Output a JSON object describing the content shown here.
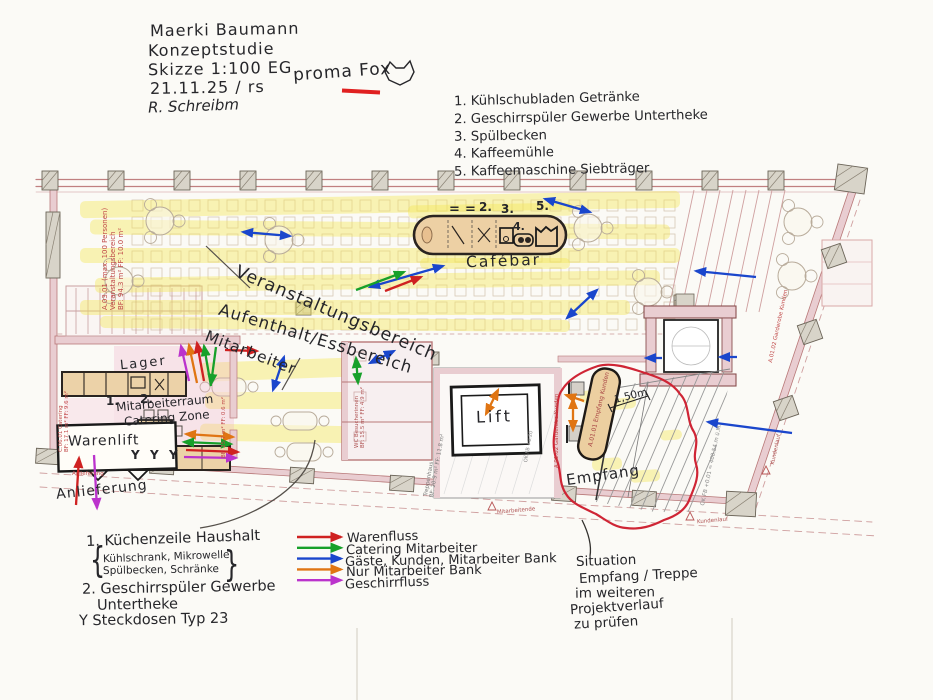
{
  "colors": {
    "ink": "#26262a",
    "red": "#cf2121",
    "green": "#17a02a",
    "blue": "#1a46cc",
    "orange": "#e07513",
    "magenta": "#bb33cc",
    "highlight": "#f2e756",
    "plan_red": "#c04848",
    "plan_pink": "#c98f96"
  },
  "header": {
    "line1": "Maerki Baumann",
    "line2": "Konzeptstudie",
    "line3": "Skizze 1:100 EG",
    "line4": "21.11.25 / rs",
    "line5": "R. Schreibm",
    "stamp": "proma Fox"
  },
  "equipment": {
    "items": [
      "1. Kühlschubladen Getränke",
      "2. Geschirrspüler Gewerbe Untertheke",
      "3. Spülbecken",
      "4. Kaffeemühle",
      "5. Kaffeemaschine Siebträger"
    ]
  },
  "legend": {
    "items": [
      {
        "label": "Warenfluss",
        "color": "#cf2121"
      },
      {
        "label": "Catering Mitarbeiter",
        "color": "#17a02a"
      },
      {
        "label": "Gäste, Kunden, Mitarbeiter Bank",
        "color": "#1a46cc"
      },
      {
        "label": "Nur Mitarbeiter Bank",
        "color": "#e07513"
      },
      {
        "label": "Geschirrfluss",
        "color": "#bb33cc"
      }
    ]
  },
  "notes_left": {
    "item1": "1. Küchenzeile Haushalt",
    "item1_sub1": "Kühlschrank, Mikrowelle,",
    "item1_sub2": "Spülbecken, Schränke",
    "brace_open": "{",
    "brace_close": "}",
    "item2": "2. Geschirrspüler Gewerbe",
    "item2b": "Untertheke",
    "item3": "Y Steckdosen Typ 23"
  },
  "notes_right": {
    "line1": "Situation",
    "line2": "Empfang / Treppe",
    "line3": "im weiteren",
    "line4": "Projektverlauf",
    "line5": "zu prüfen"
  },
  "labels": {
    "event": "Veranstaltungsbereich",
    "lounge": "Aufenthalt/Essbereich",
    "staff": "Mitarbeiter",
    "cafebar": "Cafébar",
    "lager": "Lager",
    "staffroom": "Mitarbeiterraum",
    "staffroom2": "Catering Zone",
    "warenlift": "Warenlift",
    "anlieferung": "Anlieferung",
    "lift": "Lift",
    "empfang": "Empfang",
    "dim": "1,50m"
  },
  "markers": {
    "counter1": "1.",
    "counter2": "2.",
    "bar_eq1": "=",
    "bar_eq2": "=",
    "bar2": "2.",
    "bar3": "3.",
    "bar4": "4.",
    "bar5": "5.",
    "socket1": "Y",
    "socket2": "Y",
    "socket3": "Y"
  },
  "printed": {
    "event1": "A.03.01 (max. 100 Personen)",
    "event2": "Veranstaltungsbereich",
    "event3": "BF: 94.3 m²  FF: 10.0 m²",
    "catering1": "C.06.01 Catering",
    "catering2": "BF: 17.1 m²  FF: 9.6 m²",
    "staffroom_bf": "BF: 25.7 m²  FF: 0.6 m²",
    "wc1": "WC Besucherinnen",
    "wc2": "BF: 15.5 m²  FF: 4.9 m²",
    "treppe1": "Treppenhaus",
    "treppe2": "BF: 20.9 m²  FF: 11.8 m²",
    "desk": "A.01.01 Empfang Kunden",
    "garderobe": "A.01.02 Garderobe Kunden",
    "level": "OK FB +0.01 = 408.54 m ü.M.",
    "level2": "OK FB +0.20",
    "mitarbeitende": "Mitarbeitende",
    "kundenlauf": "Kundenlauf",
    "anlieferung_small": "Anlieferung"
  }
}
